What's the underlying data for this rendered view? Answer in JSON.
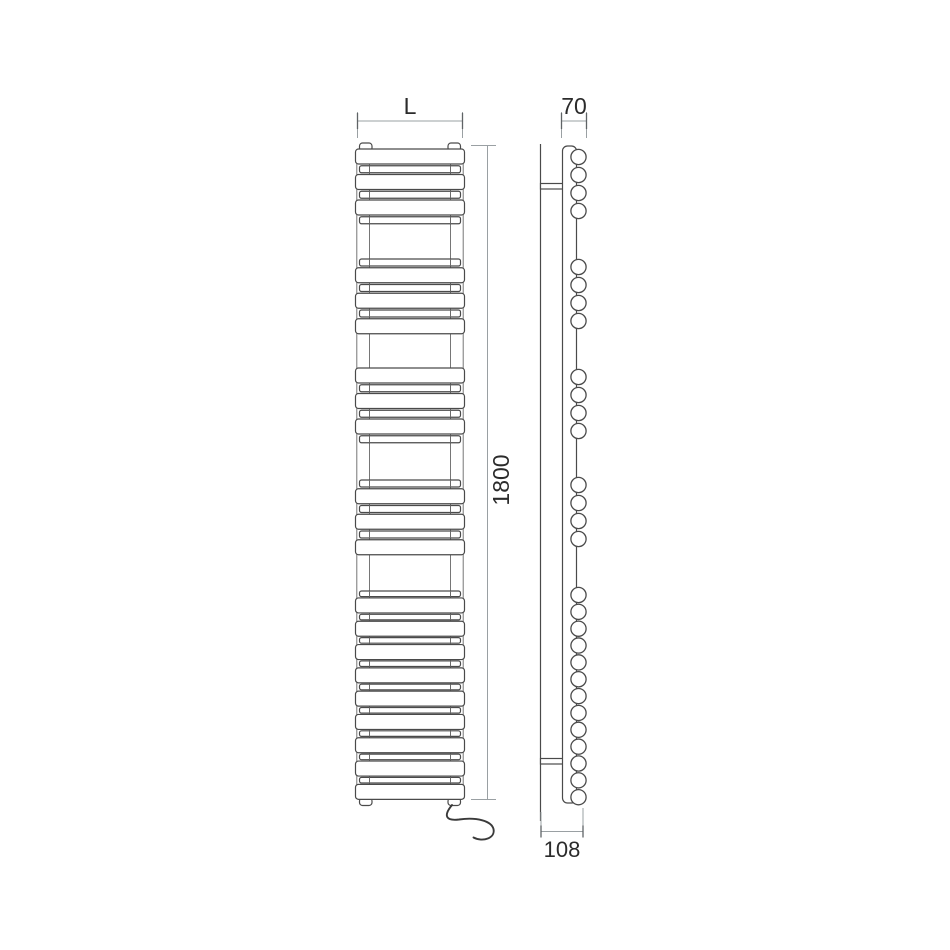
{
  "drawing": {
    "type": "technical-diagram",
    "subject": "electric towel rail radiator - front and side elevation",
    "background": "#ffffff",
    "line_color": "#4a4a4a",
    "dim_line_color": "#9aa0a3",
    "text_color": "#2b2b2b"
  },
  "dimensions": {
    "width": {
      "label": "L"
    },
    "depth_top": {
      "label": "70"
    },
    "height": {
      "label": "1800"
    },
    "depth_overall": {
      "label": "108"
    }
  },
  "front_view": {
    "bar_x": 355.5,
    "bar_width": 109,
    "narrow_x": 359.5,
    "narrow_width": 101,
    "seam_left_x": 369.5,
    "seam_right_x": 450.5,
    "groups": [
      {
        "start": 149,
        "pattern": "WnWnWn",
        "wide_h": 15,
        "narrow_h": 7,
        "gap": 1.75
      },
      {
        "start": 259,
        "pattern": "nWnWnW",
        "wide_h": 15,
        "narrow_h": 7,
        "gap": 1.75
      },
      {
        "start": 368,
        "pattern": "WnWnWn",
        "wide_h": 15,
        "narrow_h": 7,
        "gap": 1.75
      },
      {
        "start": 480,
        "pattern": "nWnWnW",
        "wide_h": 15,
        "narrow_h": 7,
        "gap": 1.75
      },
      {
        "start": 591,
        "pattern": "nWnWnWnWnWnWnWnWnW",
        "wide_h": 15,
        "narrow_h": 5.6,
        "gap": 1.35
      }
    ]
  },
  "side_view": {
    "tube_cx": 578.5,
    "tube_r": 7.6,
    "tube_groups": [
      {
        "start": 157,
        "count": 4,
        "spacing": 18
      },
      {
        "start": 267,
        "count": 4,
        "spacing": 18
      },
      {
        "start": 377,
        "count": 4,
        "spacing": 18
      },
      {
        "start": 485,
        "count": 4,
        "spacing": 18
      },
      {
        "start": 595,
        "count": 13,
        "spacing": 16.85
      }
    ]
  }
}
